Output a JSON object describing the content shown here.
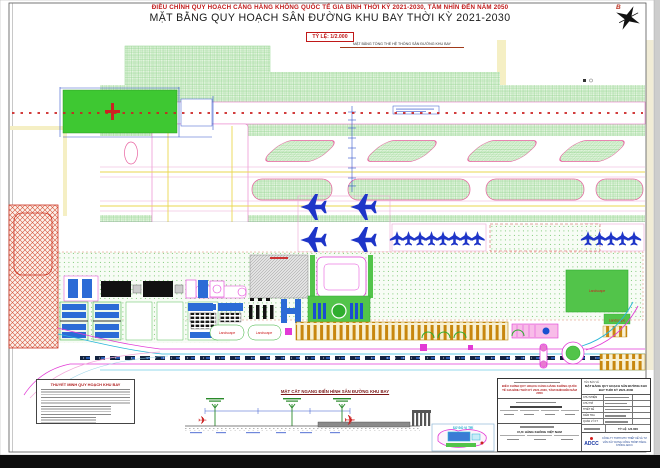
{
  "header": {
    "project_line": "ĐIỀU CHỈNH QUY HOẠCH CẢNG HÀNG KHÔNG QUỐC TẾ GIA BÌNH THỜI KỲ 2021-2030, TẦM NHÌN ĐẾN NĂM 2050",
    "drawing_title": "MẶT BẰNG QUY HOẠCH SÂN ĐƯỜNG KHU BAY THỜI KỲ 2021-2030",
    "scale_label": "TỶ LỆ: 1/2.000",
    "overview_label": "MẶT BẰNG TỔNG THỂ HỆ THỐNG SÂN ĐƯỜNG KHU BAY",
    "north_label": "B"
  },
  "plan": {
    "landscape_labels": [
      "Landscape",
      "Landscape",
      "Landscape",
      "Landscape"
    ],
    "colors": {
      "strip_hatch_green": "#8ed288",
      "runway_pad_green": "#3ec832",
      "taxiway_edge_pink": "#e878c8",
      "aircraft_blue": "#1e35c8",
      "restricted_hatch_red": "#d4553a",
      "road_magenta": "#e23ad6",
      "centerline_red": "#cc2222",
      "guideline_yellow": "#ead74f",
      "terminal_comb_orange": "#c8870e"
    }
  },
  "notes_panel": {
    "title": "THUYẾT MINH QUY HOẠCH KHU BAY"
  },
  "cross_section": {
    "title": "MẶT CẮT NGANG ĐIỂN HÌNH SÂN ĐƯỜNG KHU BAY"
  },
  "location_inset": {
    "title": "SƠ ĐỒ VỊ TRÍ"
  },
  "title_block": {
    "project_name": "ĐIỀU CHỈNH QUY HOẠCH CẢNG HÀNG KHÔNG QUỐC TẾ GIA BÌNH THỜI KỲ 2021-2030, TẦM NHÌN ĐẾN NĂM 2050",
    "drawing_name_label": "TÊN BẢN VẼ",
    "drawing_name": "MẶT BẰNG QUY HOẠCH SÂN ĐƯỜNG KHU BAY THỜI KỲ 2021-2030",
    "agency_name": "CỤC HÀNG KHÔNG VIỆT NAM",
    "roles": [
      "CHỦ NHIỆM",
      "CHỦ TRÌ",
      "THIẾT KẾ",
      "KIỂM TRA",
      "QUẢN LÝ KT"
    ],
    "scale_row_label": "TỶ LỆ",
    "scale_value": "1/2.000",
    "consultant_logo": "ADCC",
    "consultant_name": "CÔNG TY TNHH MTV THIẾT KẾ VÀ TƯ VẤN XÂY DỰNG CÔNG TRÌNH HÀNG KHÔNG ADCC"
  },
  "icons": {
    "airplane": "✈"
  }
}
